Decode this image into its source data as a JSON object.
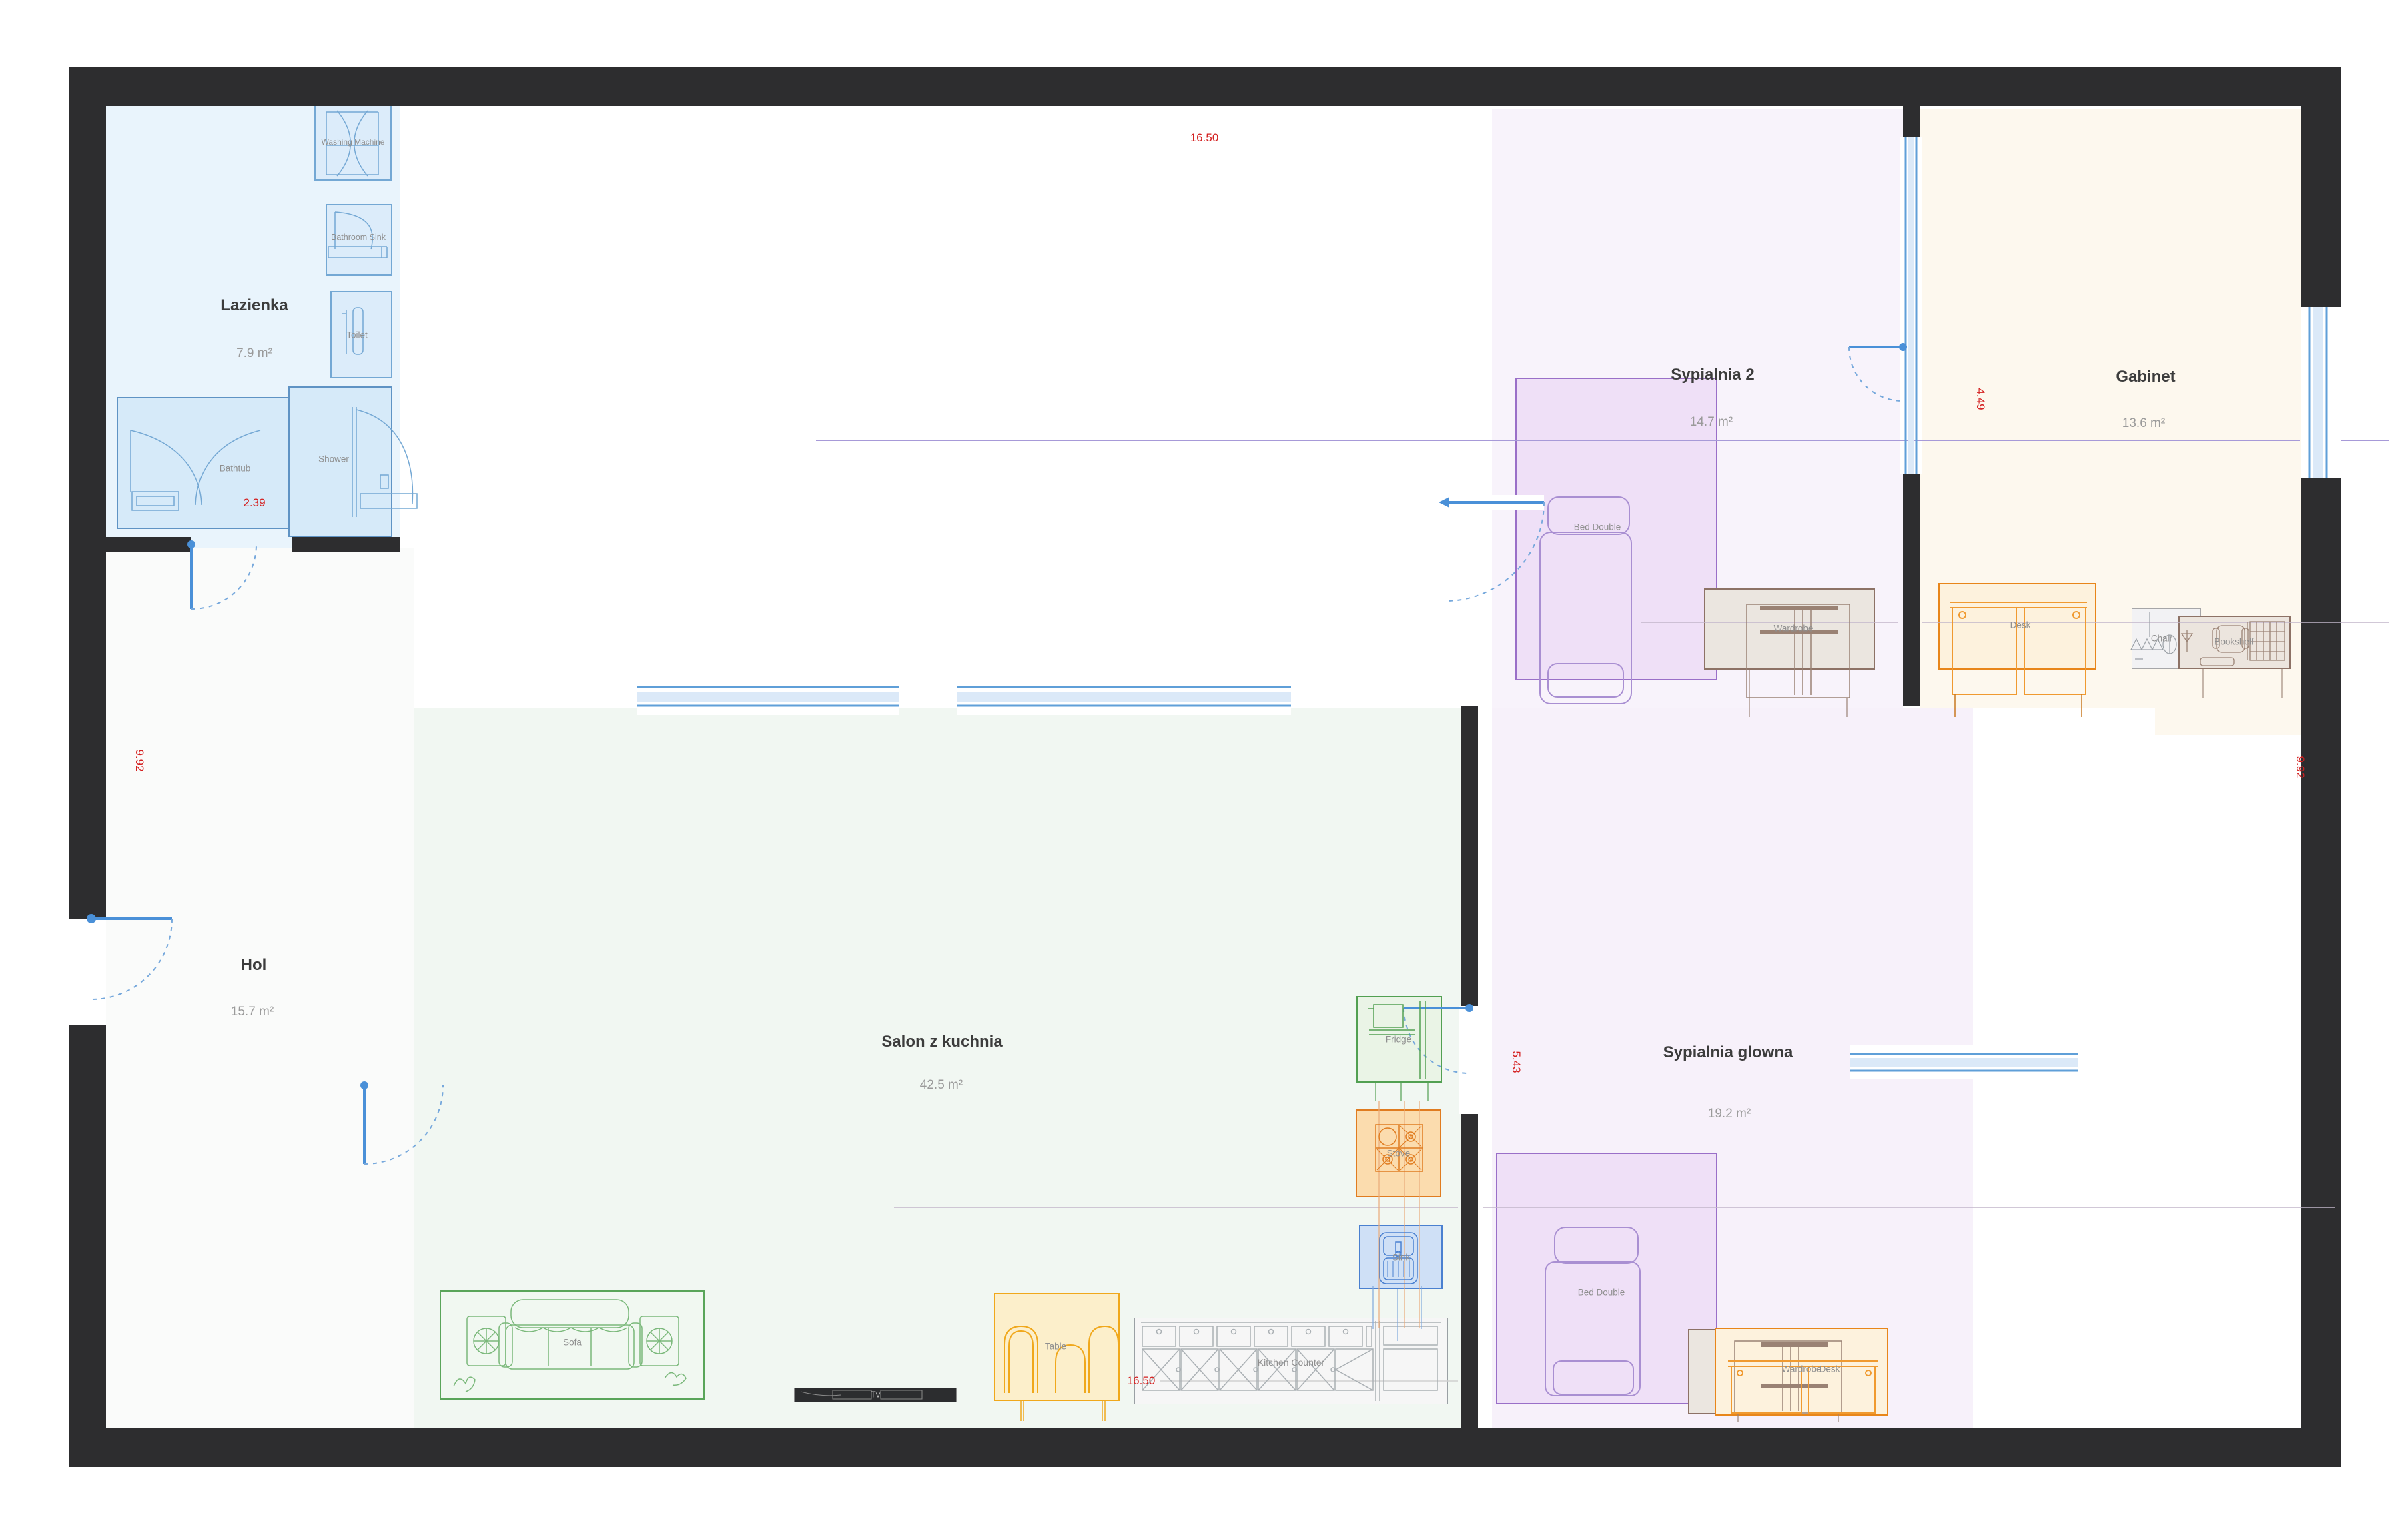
{
  "floorplan": {
    "rooms": [
      {
        "name": "Lazienka",
        "area": "7.9 m²"
      },
      {
        "name": "Hol",
        "area": "15.7 m²"
      },
      {
        "name": "Salon z kuchnia",
        "area": "42.5 m²"
      },
      {
        "name": "Sypialnia 2",
        "area": "14.7 m²"
      },
      {
        "name": "Sypialnia glowna",
        "area": "19.2 m²"
      },
      {
        "name": "Gabinet",
        "area": "13.6 m²"
      }
    ],
    "furniture": {
      "washing_machine": "Washing Machine",
      "bathroom_sink": "Bathroom Sink",
      "toilet": "Toilet",
      "bathtub": "Bathtub",
      "shower": "Shower",
      "bed_double": "Bed Double",
      "wardrobe": "Wardrobe",
      "desk": "Desk",
      "chair": "Chair",
      "bookshelf": "Bookshelf",
      "fridge": "Fridge",
      "stove": "Stove",
      "sink": "Sink",
      "sofa": "Sofa",
      "tv": "Tv",
      "table": "Table",
      "kitchen_counter": "Kitchen Counter"
    },
    "dimensions": {
      "top_width": "16.50",
      "bottom_width": "16.50",
      "left_height": "9.92",
      "right_height": "9.92",
      "bathroom_width": "2.39",
      "gabinet_height": "4.49",
      "salon_height": "5.43"
    },
    "colors": {
      "wall": "#2d2d2f",
      "door_window_blue": "#4a90d8",
      "dimension_red": "#d42020",
      "bathroom_zone": "#e9f4fc",
      "salon_zone": "#f1f7f2",
      "bedroom_zone": "#f8f3fb",
      "gabinet_zone": "#fdf8ee",
      "guide_purple": "#a79ad8"
    }
  }
}
